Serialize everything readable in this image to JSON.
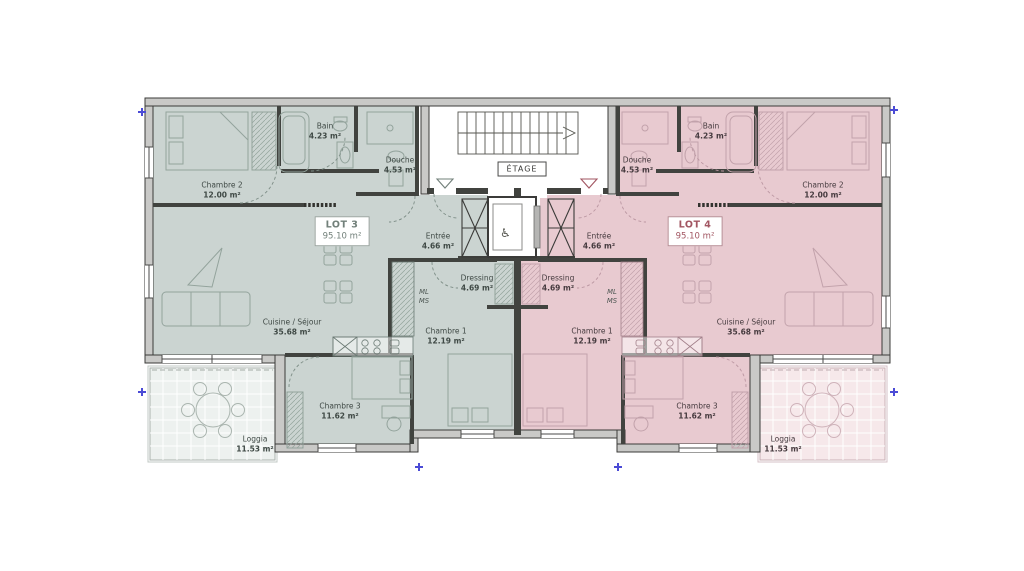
{
  "floor": {
    "label": "ÉTAGE"
  },
  "lot3": {
    "label": "LOT 3",
    "area": "95.10 m²",
    "rooms": {
      "chambre2": {
        "name": "Chambre 2",
        "area": "12.00 m²"
      },
      "bain": {
        "name": "Bain",
        "area": "4.23 m²"
      },
      "douche": {
        "name": "Douche",
        "area": "4.53 m²"
      },
      "entree": {
        "name": "Entrée",
        "area": "4.66 m²"
      },
      "dressing": {
        "name": "Dressing",
        "area": "4.69 m²"
      },
      "chambre1": {
        "name": "Chambre 1",
        "area": "12.19 m²"
      },
      "cuisine": {
        "name": "Cuisine / Séjour",
        "area": "35.68 m²"
      },
      "chambre3": {
        "name": "Chambre 3",
        "area": "11.62 m²"
      },
      "loggia": {
        "name": "Loggia",
        "area": "11.53 m²"
      },
      "ml_ms": {
        "line1": "ML",
        "line2": "MS"
      }
    }
  },
  "lot4": {
    "label": "LOT 4",
    "area": "95.10 m²",
    "rooms": {
      "chambre2": {
        "name": "Chambre 2",
        "area": "12.00 m²"
      },
      "bain": {
        "name": "Bain",
        "area": "4.23 m²"
      },
      "douche": {
        "name": "Douche",
        "area": "4.53 m²"
      },
      "entree": {
        "name": "Entrée",
        "area": "4.66 m²"
      },
      "dressing": {
        "name": "Dressing",
        "area": "4.69 m²"
      },
      "chambre1": {
        "name": "Chambre 1",
        "area": "12.19 m²"
      },
      "cuisine": {
        "name": "Cuisine / Séjour",
        "area": "35.68 m²"
      },
      "chambre3": {
        "name": "Chambre 3",
        "area": "11.62 m²"
      },
      "loggia": {
        "name": "Loggia",
        "area": "11.53 m²"
      },
      "ml_ms": {
        "line1": "ML",
        "line2": "MS"
      }
    }
  },
  "colors": {
    "lot3_fill": "#cbd4d1",
    "lot4_fill": "#e8cad0",
    "lot3_loggia": "#edf1ef",
    "lot4_loggia": "#f6e8ea",
    "lot3_accent": "#72807a",
    "lot4_accent": "#a25662",
    "wall_fill": "#c9c9c7",
    "wall_edge": "#3b3b39",
    "marker": "#4b4bd6"
  }
}
